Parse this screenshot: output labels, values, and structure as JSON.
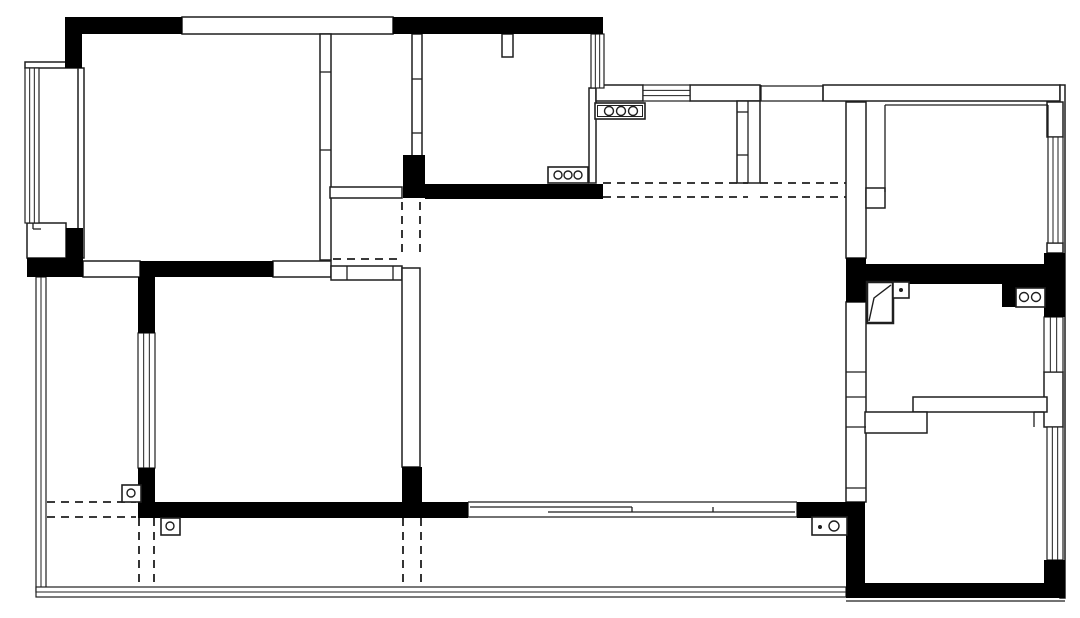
{
  "canvas": {
    "width": 1080,
    "height": 618,
    "background": "#ffffff",
    "line_color": "#1f1f1f",
    "wall_fill": "#000000",
    "dash_pattern": "8 6"
  },
  "plan": {
    "solid_walls": [
      [
        65,
        17,
        117,
        17
      ],
      [
        65,
        34,
        17,
        34
      ],
      [
        393,
        17,
        210,
        17
      ],
      [
        403,
        155,
        22,
        43
      ],
      [
        425,
        184,
        178,
        15
      ],
      [
        27,
        258,
        56,
        19
      ],
      [
        66,
        228,
        17,
        30
      ],
      [
        140,
        261,
        133,
        16
      ],
      [
        138,
        277,
        17,
        56
      ],
      [
        138,
        468,
        17,
        34
      ],
      [
        138,
        502,
        330,
        16
      ],
      [
        402,
        467,
        20,
        35
      ],
      [
        797,
        502,
        68,
        16
      ],
      [
        846,
        502,
        19,
        96
      ],
      [
        863,
        583,
        202,
        15
      ],
      [
        1044,
        560,
        21,
        38
      ],
      [
        846,
        258,
        20,
        44
      ],
      [
        846,
        264,
        219,
        20
      ],
      [
        1002,
        264,
        45,
        43
      ],
      [
        1044,
        253,
        21,
        64
      ]
    ],
    "outlined_walls": [
      [
        182,
        17,
        211,
        17
      ],
      [
        25,
        62,
        53,
        6
      ],
      [
        27,
        223,
        39,
        35
      ],
      [
        78,
        68,
        6,
        190
      ],
      [
        320,
        34,
        11,
        226
      ],
      [
        412,
        34,
        10,
        123
      ],
      [
        502,
        34,
        11,
        23
      ],
      [
        330,
        187,
        72,
        11
      ],
      [
        589,
        88,
        7,
        95
      ],
      [
        596,
        85,
        47,
        16
      ],
      [
        690,
        85,
        70,
        16
      ],
      [
        823,
        85,
        237,
        16
      ],
      [
        1060,
        85,
        5,
        513
      ],
      [
        737,
        101,
        23,
        82
      ],
      [
        846,
        102,
        20,
        156
      ],
      [
        866,
        188,
        19,
        20
      ],
      [
        1047,
        102,
        16,
        35
      ],
      [
        1047,
        243,
        16,
        10
      ],
      [
        846,
        302,
        20,
        200
      ],
      [
        1044,
        372,
        19,
        55
      ],
      [
        913,
        397,
        134,
        15
      ],
      [
        865,
        412,
        62,
        21
      ],
      [
        83,
        261,
        57,
        16
      ],
      [
        273,
        261,
        58,
        16
      ],
      [
        331,
        266,
        71,
        14
      ],
      [
        402,
        268,
        18,
        199
      ]
    ],
    "lines": [
      [
        320,
        72,
        331,
        72
      ],
      [
        320,
        150,
        331,
        150
      ],
      [
        412,
        79,
        422,
        79
      ],
      [
        412,
        133,
        422,
        133
      ],
      [
        748,
        101,
        748,
        183
      ],
      [
        737,
        112,
        748,
        112
      ],
      [
        737,
        155,
        748,
        155
      ],
      [
        885,
        105,
        885,
        192
      ],
      [
        885,
        105,
        1048,
        105
      ],
      [
        1048,
        105,
        1048,
        137
      ],
      [
        846,
        372,
        866,
        372
      ],
      [
        846,
        397,
        866,
        397
      ],
      [
        846,
        427,
        866,
        427
      ],
      [
        846,
        488,
        866,
        488
      ],
      [
        347,
        266,
        347,
        280
      ],
      [
        393,
        266,
        393,
        280
      ],
      [
        468,
        502,
        797,
        502
      ],
      [
        468,
        517,
        797,
        517
      ],
      [
        470,
        507,
        632,
        507
      ],
      [
        548,
        512,
        795,
        512
      ],
      [
        632,
        507,
        632,
        512
      ],
      [
        713,
        507,
        713,
        512
      ],
      [
        468,
        502,
        468,
        517
      ],
      [
        797,
        502,
        797,
        517
      ],
      [
        761,
        85,
        761,
        101
      ],
      [
        823,
        85,
        823,
        101
      ],
      [
        761,
        86,
        823,
        86
      ],
      [
        760,
        101,
        823,
        101
      ],
      [
        846,
        601,
        1065,
        601
      ],
      [
        33,
        223,
        33,
        229
      ],
      [
        33,
        229,
        41,
        229
      ],
      [
        1034,
        412,
        1044,
        412
      ],
      [
        1034,
        412,
        1034,
        427
      ]
    ],
    "dashed_lines": [
      [
        603,
        183,
        748,
        183
      ],
      [
        603,
        197,
        748,
        197
      ],
      [
        760,
        183,
        846,
        183
      ],
      [
        760,
        197,
        846,
        197
      ],
      [
        402,
        202,
        402,
        258
      ],
      [
        420,
        202,
        420,
        258
      ],
      [
        333,
        259,
        400,
        259
      ],
      [
        47,
        502,
        136,
        502
      ],
      [
        47,
        517,
        136,
        517
      ],
      [
        139,
        518,
        139,
        586
      ],
      [
        154,
        518,
        154,
        586
      ],
      [
        403,
        518,
        403,
        586
      ],
      [
        421,
        518,
        421,
        586
      ]
    ],
    "windows": [
      {
        "x": 25,
        "y": 68,
        "w": 14,
        "h": 155,
        "dir": "v",
        "inner": 2
      },
      {
        "x": 36,
        "y": 277,
        "w": 10,
        "h": 315,
        "dir": "v",
        "inner": 1
      },
      {
        "x": 36,
        "y": 587,
        "w": 810,
        "h": 10,
        "dir": "h",
        "inner": 1
      },
      {
        "x": 591,
        "y": 34,
        "w": 13,
        "h": 54,
        "dir": "v",
        "inner": 2
      },
      {
        "x": 643,
        "y": 85,
        "w": 47,
        "h": 16,
        "dir": "h",
        "inner": 2
      },
      {
        "x": 1048,
        "y": 137,
        "w": 15,
        "h": 106,
        "dir": "v",
        "inner": 2
      },
      {
        "x": 1044,
        "y": 317,
        "w": 19,
        "h": 55,
        "dir": "v",
        "inner": 2
      },
      {
        "x": 1047,
        "y": 427,
        "w": 16,
        "h": 133,
        "dir": "v",
        "inner": 2
      },
      {
        "x": 138,
        "y": 333,
        "w": 17,
        "h": 135,
        "dir": "v",
        "inner": 2
      }
    ],
    "fixtures": [
      {
        "name": "shower-panel-symbol",
        "x": 867,
        "y": 282,
        "w": 26,
        "h": 41,
        "stroke": 2.5,
        "path": "M869,321 L874,298 L891,285"
      }
    ],
    "circle_boxes": [
      {
        "name": "stove-burners-symbol",
        "x": 595,
        "y": 103,
        "w": 50,
        "h": 16,
        "inner": true,
        "circles": [
          [
            609,
            111,
            4.5
          ],
          [
            621,
            111,
            4.5
          ],
          [
            633,
            111,
            4.5
          ]
        ],
        "dots": []
      },
      {
        "name": "stove-burners-symbol",
        "x": 548,
        "y": 167,
        "w": 40,
        "h": 16,
        "inner": false,
        "circles": [
          [
            558,
            175,
            4
          ],
          [
            568,
            175,
            4
          ],
          [
            578,
            175,
            4
          ]
        ],
        "dots": []
      },
      {
        "name": "sink-symbol",
        "x": 1016,
        "y": 288,
        "w": 29,
        "h": 19,
        "inner": false,
        "circles": [
          [
            1024,
            297,
            4.5
          ],
          [
            1036,
            297,
            4.5
          ]
        ],
        "dots": []
      },
      {
        "name": "switch-box-symbol",
        "x": 893,
        "y": 282,
        "w": 16,
        "h": 16,
        "inner": false,
        "circles": [],
        "dots": [
          [
            901,
            290,
            2
          ]
        ]
      },
      {
        "name": "floor-drain-symbol",
        "x": 122,
        "y": 485,
        "w": 19,
        "h": 17,
        "inner": false,
        "circles": [
          [
            131,
            493,
            4
          ]
        ],
        "dots": []
      },
      {
        "name": "floor-drain-symbol",
        "x": 161,
        "y": 518,
        "w": 19,
        "h": 17,
        "inner": false,
        "circles": [
          [
            170,
            526,
            4
          ]
        ],
        "dots": []
      },
      {
        "name": "floor-drain-symbol",
        "x": 812,
        "y": 517,
        "w": 35,
        "h": 18,
        "inner": false,
        "circles": [
          [
            834,
            526,
            5
          ]
        ],
        "dots": [
          [
            820,
            527,
            2
          ]
        ]
      }
    ]
  }
}
